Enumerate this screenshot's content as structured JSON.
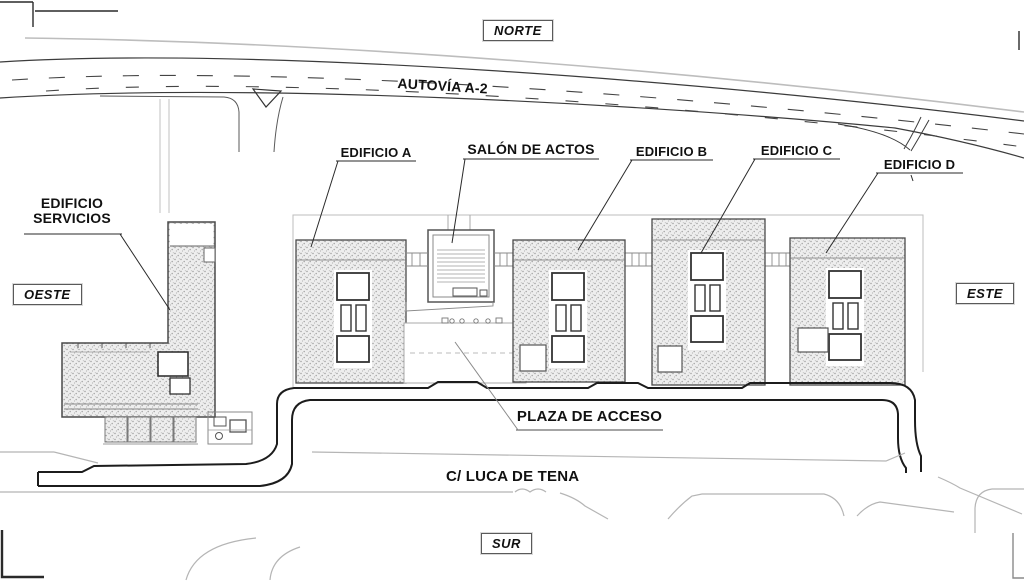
{
  "compass": {
    "north": "NORTE",
    "south": "SUR",
    "east": "ESTE",
    "west": "OESTE"
  },
  "roads": {
    "highway": "AUTOVÍA A-2",
    "street": "C/ LUCA DE TENA"
  },
  "labels": {
    "building_a": "EDIFICIO A",
    "salon": "SALÓN DE ACTOS",
    "building_b": "EDIFICIO B",
    "building_c": "EDIFICIO C",
    "building_d": "EDIFICIO D",
    "services_line1": "EDIFICIO",
    "services_line2": "SERVICIOS",
    "plaza": "PLAZA DE ACCESO"
  },
  "colors": {
    "paper": "#ffffff",
    "ink": "#1c1c1c",
    "line_light": "#b5b5b5",
    "hatch_dot": "#9a9a9a"
  }
}
